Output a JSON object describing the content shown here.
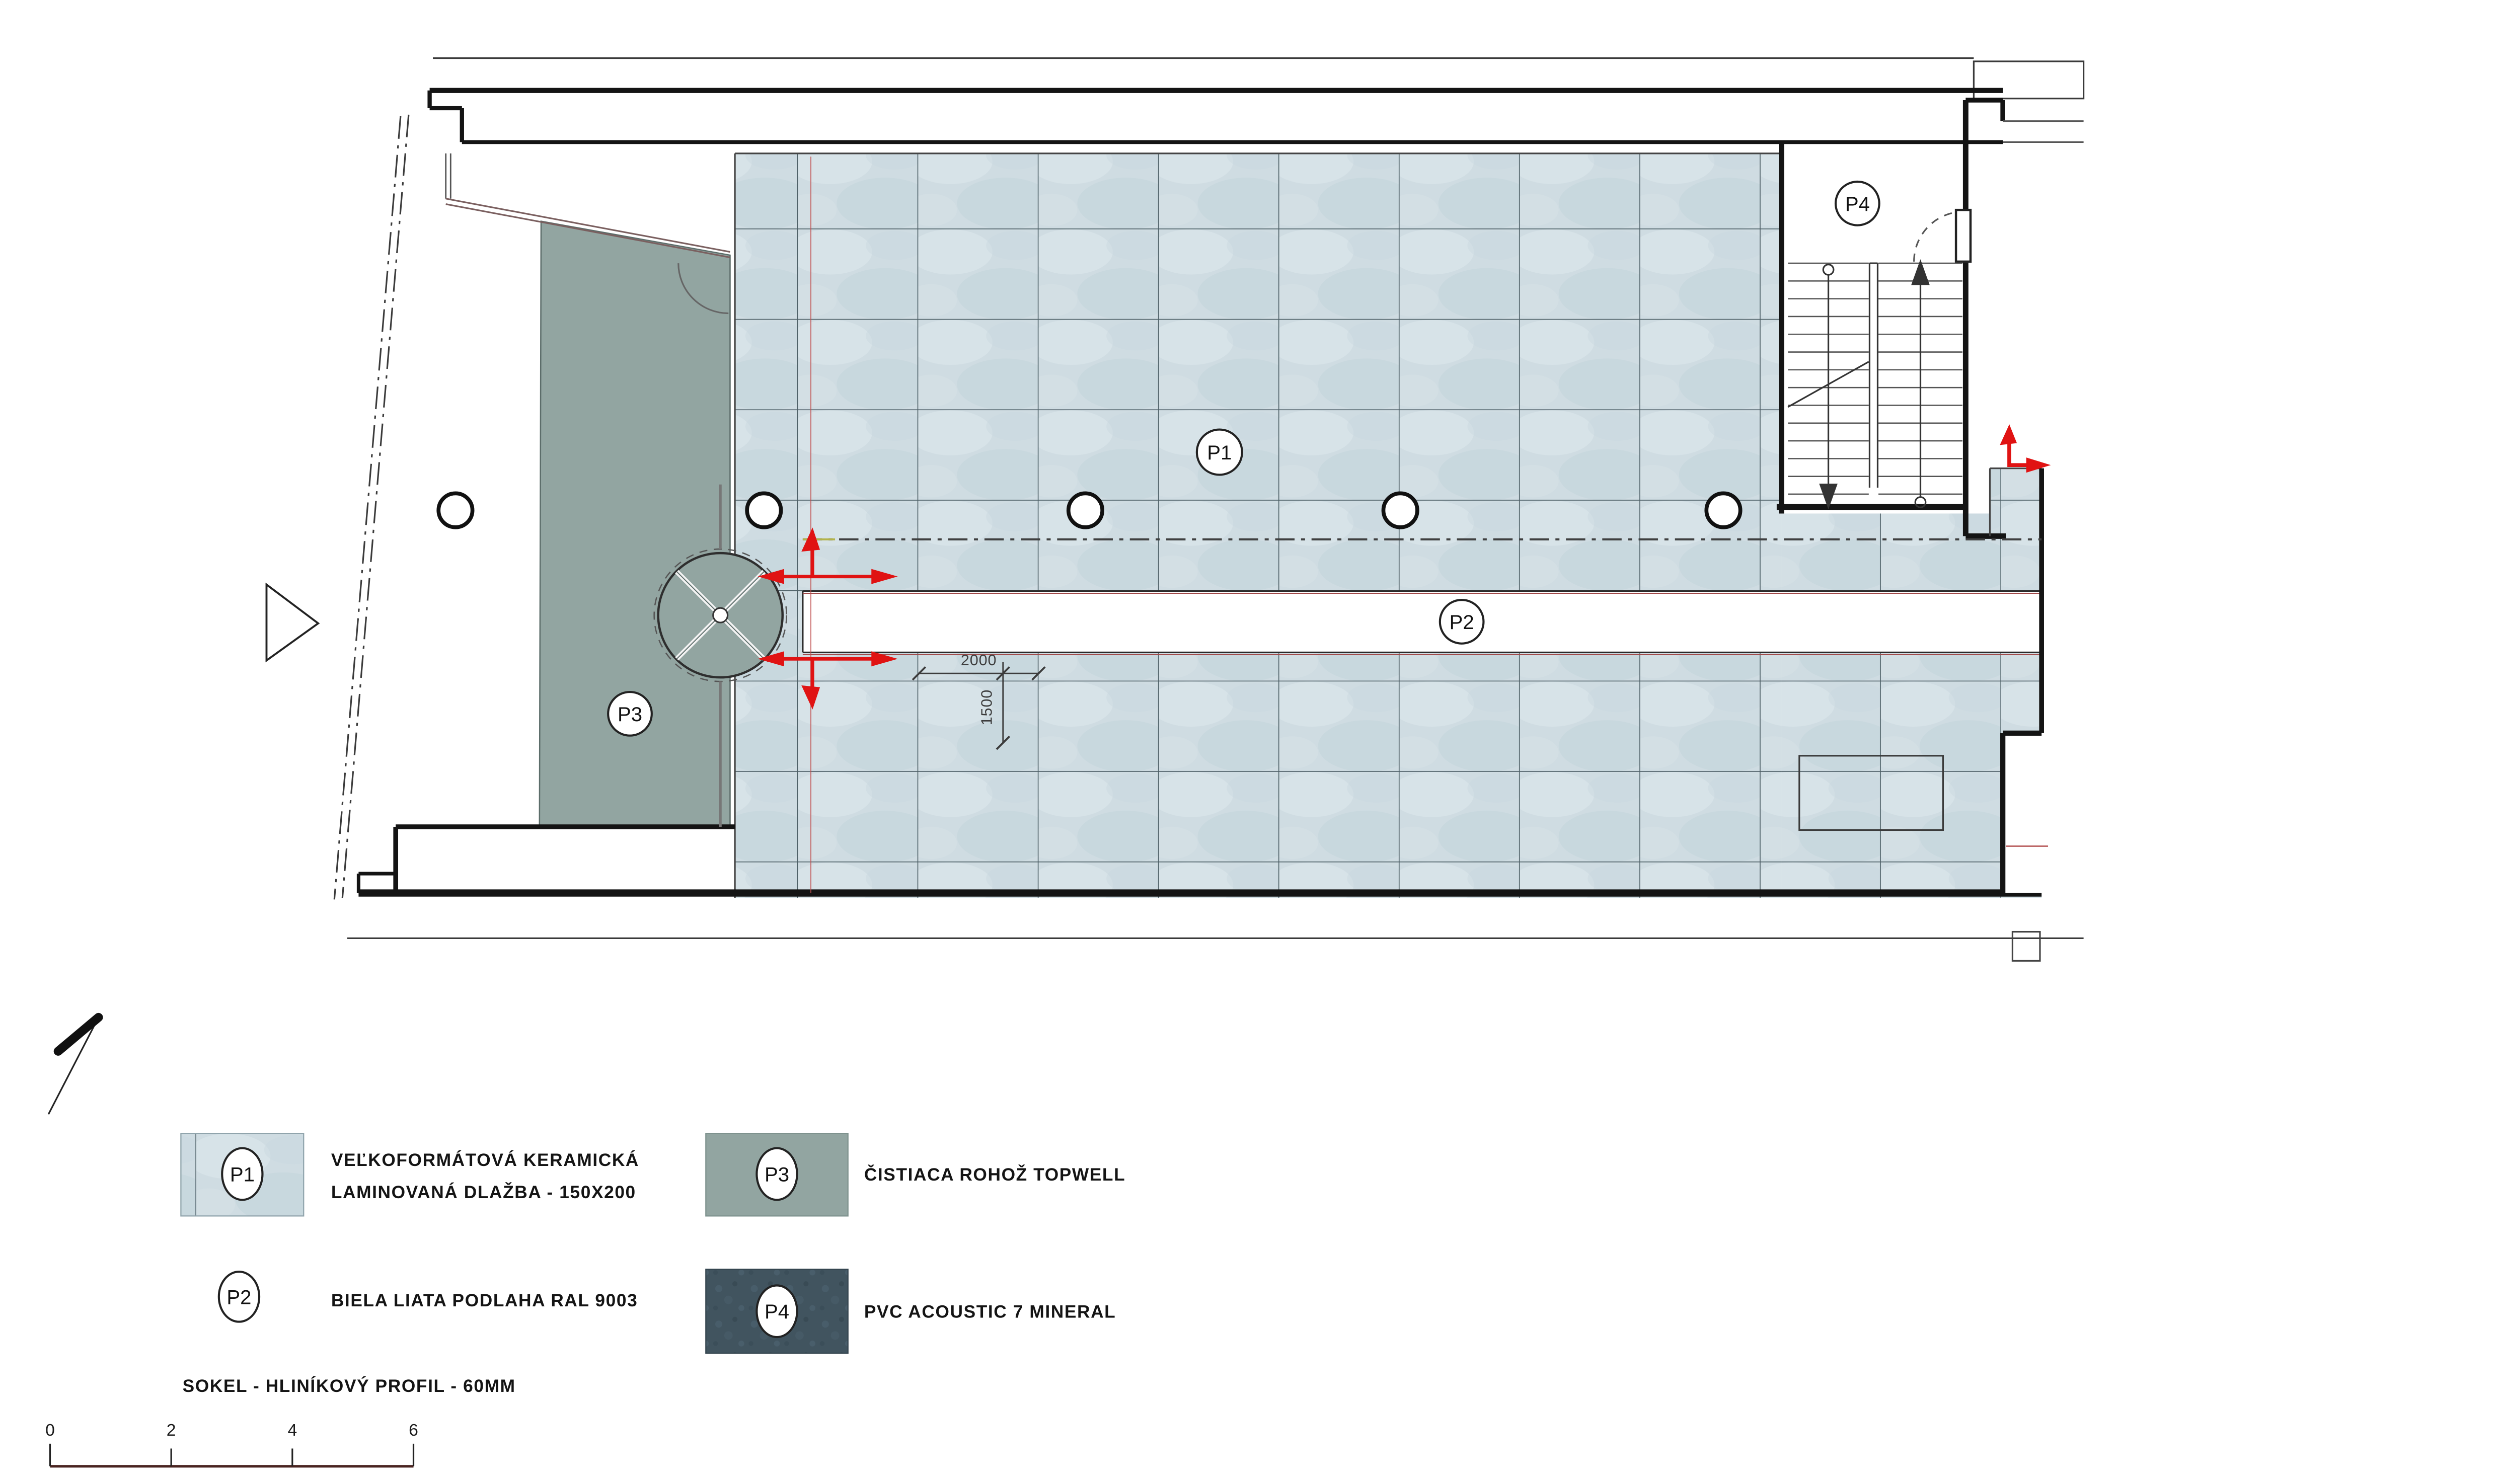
{
  "plan": {
    "room_labels": {
      "p1": "P1",
      "p2": "P2",
      "p3": "P3",
      "p4": "P4"
    },
    "dimensions": {
      "horizontal": "2000",
      "vertical": "1500"
    }
  },
  "legend": {
    "items": [
      {
        "code": "P1",
        "description_line1": "VEĽKOFORMÁTOVÁ KERAMICKÁ",
        "description_line2": "LAMINOVANÁ DLAŽBA - 150X200"
      },
      {
        "code": "P2",
        "description_line1": "BIELA LIATA PODLAHA RAL 9003",
        "description_line2": ""
      },
      {
        "code": "P3",
        "description_line1": "ČISTIACA ROHOŽ TOPWELL",
        "description_line2": ""
      },
      {
        "code": "P4",
        "description_line1": "PVC ACOUSTIC 7 MINERAL",
        "description_line2": ""
      }
    ],
    "note": "SOKEL - HLINÍKOVÝ PROFIL - 60MM"
  },
  "scale_bar": {
    "ticks": [
      "0",
      "2",
      "4",
      "6"
    ]
  },
  "colors": {
    "tile": "#cfdce2",
    "mat": "#92a5a1",
    "pvc": "#41545f",
    "red": "#e01313",
    "line": "#1b1b1b"
  }
}
